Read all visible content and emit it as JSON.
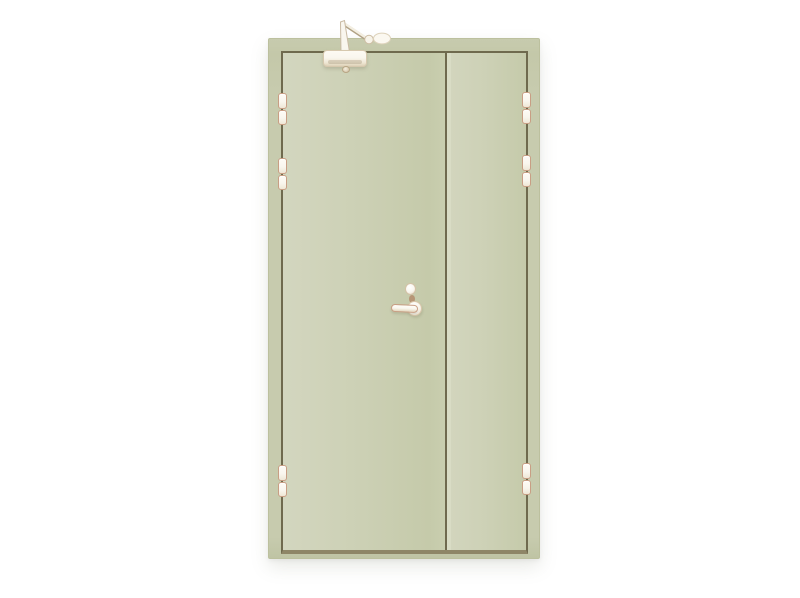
{
  "scene": {
    "description": "Product photo of a pale sage-green double-leaf steel fire door with unequal leaves, fitted with an overhead door closer, lever handle, lock cylinder and six barrel hinges, on a plain white background",
    "background": "#ffffff"
  },
  "door": {
    "frame": "#c7cbae",
    "leaf": "#cdd1b6",
    "leaf_light": "#d3d6bf",
    "leaf_dark": "#c5caaa",
    "groove": "#6f6a4e",
    "sill": "#8e8667",
    "stile_highlight": "#d9dcc5"
  },
  "hardware": {
    "white": "#f9f6ee",
    "shade": "#e7ddc9",
    "outline": "#c89e84",
    "accent": "#a96a4a",
    "items": {
      "door_closer": "overhead door closer with arm",
      "handle": "lever handle",
      "cylinder": "lock cylinder",
      "hinges_left": 3,
      "hinges_right": 3
    }
  }
}
